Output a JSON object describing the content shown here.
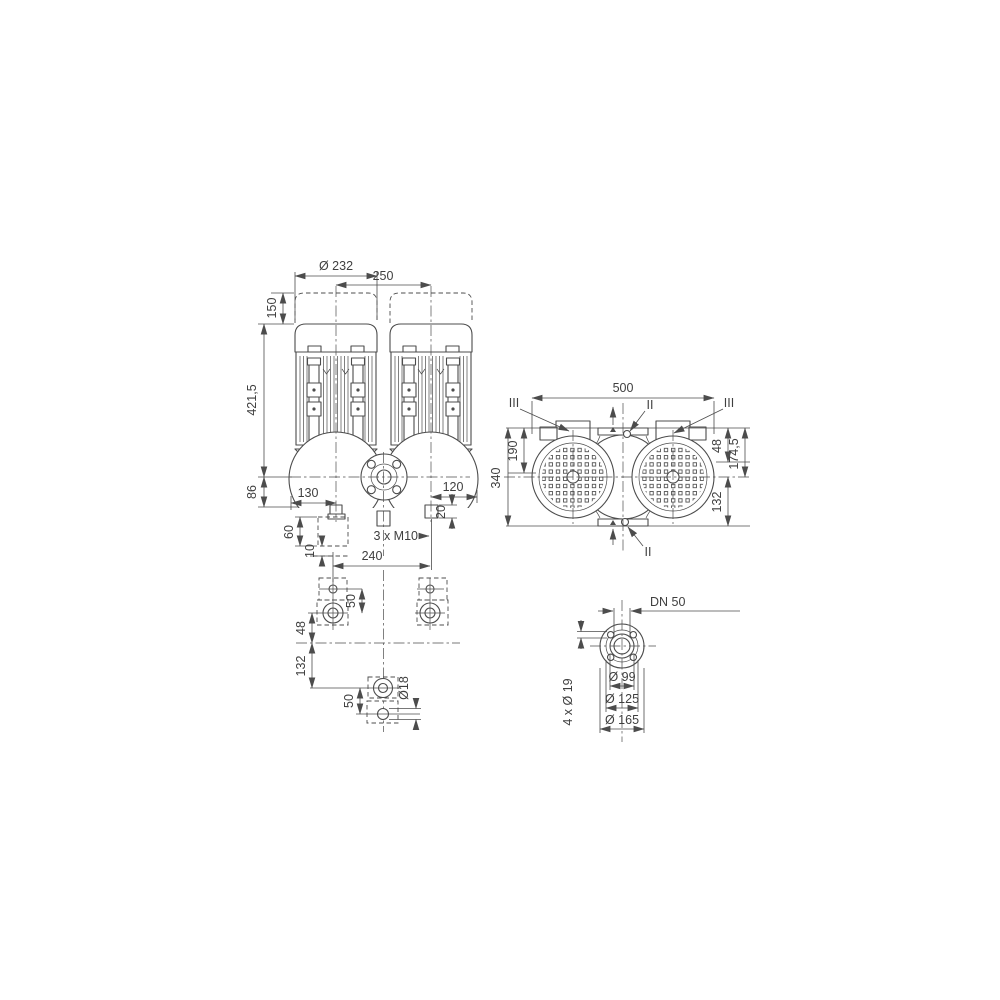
{
  "colors": {
    "background": "#ffffff",
    "line": "#4c4c4c",
    "text": "#3f3f3f"
  },
  "front_view": {
    "dims": {
      "motor_diameter": "Ø 232",
      "axis_spacing": "250",
      "removal_clearance": "150",
      "motor_height": "421,5",
      "axis_to_base": "86",
      "base_left": "130",
      "base_right": "120",
      "pad_height": "60",
      "pad_shim": "10",
      "plugs": "3 x M10",
      "plug_depth": "20"
    }
  },
  "plan_view": {
    "dims": {
      "overall_width": "500",
      "face_to_axis": "190",
      "overall_depth": "340",
      "face_to_shoulder": "48",
      "face_to_motor_axis": "174,5",
      "axis_to_rear": "132"
    },
    "sections": {
      "left": "III",
      "right": "III",
      "top": "II",
      "bottom": "II"
    }
  },
  "foundation_view": {
    "dims": {
      "hole_spacing": "240",
      "front_hole_offset": "50",
      "axis_to_front_row": "48",
      "axis_to_rear_hole": "132",
      "rear_hole_offset": "50",
      "hole_diameter": "Ø18"
    }
  },
  "flange_view": {
    "dims": {
      "nominal_bore": "DN 50",
      "bolt_holes": "4 x Ø 19",
      "hub_diameter": "Ø 99",
      "bolt_circle_diameter": "Ø 125",
      "outer_diameter": "Ø 165"
    }
  }
}
